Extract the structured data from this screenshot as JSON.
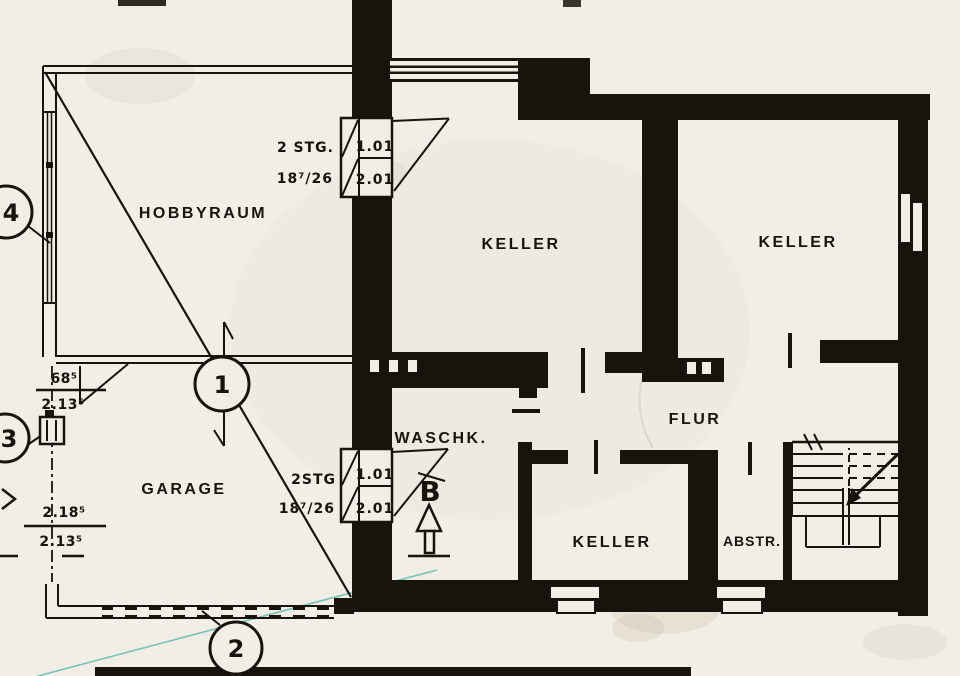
{
  "drawing": {
    "kind": "basement floor plan (scanned blueprint)",
    "colors": {
      "paper": "#f1eee6",
      "ink": "#17130d",
      "teal_pen": "#179690"
    }
  },
  "rooms": {
    "hobbyraum": {
      "label": "HOBBYRAUM"
    },
    "garage": {
      "label": "GARAGE"
    },
    "keller_top_left": {
      "label": "KELLER"
    },
    "keller_top_right": {
      "label": "KELLER"
    },
    "waschkueche": {
      "label": "WASCHK."
    },
    "flur": {
      "label": "FLUR"
    },
    "keller_bottom": {
      "label": "KELLER"
    },
    "abstellraum": {
      "label": "ABSTR."
    }
  },
  "stairs": {
    "upper": {
      "steps_label_line1": "2 STG.",
      "steps_label_line2": "18⁷/26",
      "level_top": "1.01",
      "level_bottom": "2.01"
    },
    "lower": {
      "steps_label_line1": "2STG",
      "steps_label_line2": "18⁷/26",
      "level_top": "1.01",
      "level_bottom": "2.01"
    }
  },
  "markers": {
    "detail_1": "1",
    "detail_2": "2",
    "detail_3": "3",
    "detail_4": "4",
    "section_b": "B"
  },
  "dimensions": {
    "offset_top": "68⁵",
    "offset_bottom": "2.13⁵",
    "garage_top": "2.18⁵",
    "garage_bottom": "2.13⁵"
  }
}
